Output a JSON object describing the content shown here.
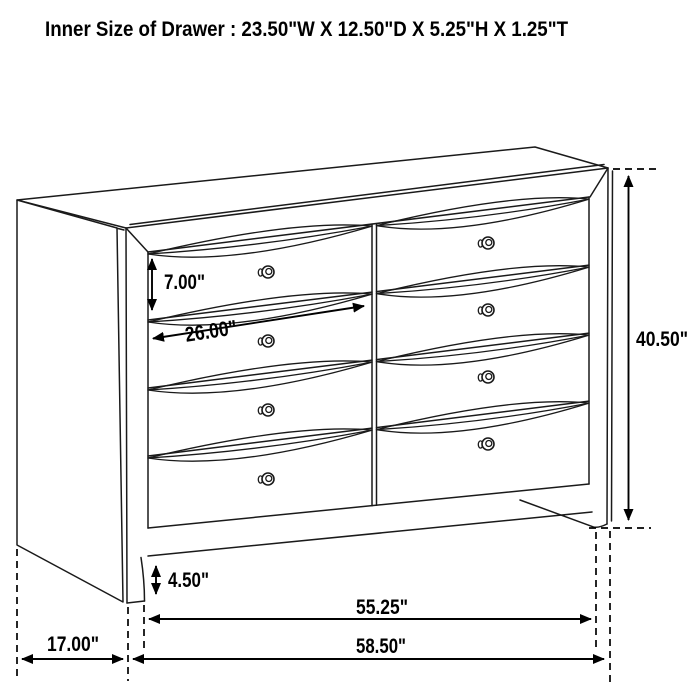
{
  "title": "Inner Size of Drawer : 23.50\"W X 12.50\"D X 5.25\"H X 1.25\"T",
  "dimensions": {
    "drawer_front_height": "7.00\"",
    "drawer_width": "26.00\"",
    "overall_height": "40.50\"",
    "foot_height": "4.50\"",
    "case_width": "55.25\"",
    "side_depth": "17.00\"",
    "overall_width": "58.50\""
  },
  "diagram": {
    "subject": "dresser",
    "drawer_columns": 2,
    "drawer_rows": 4,
    "drawer_count": 8
  },
  "colors": {
    "background": "#ffffff",
    "line": "#1a1a1a",
    "text": "#000000"
  }
}
